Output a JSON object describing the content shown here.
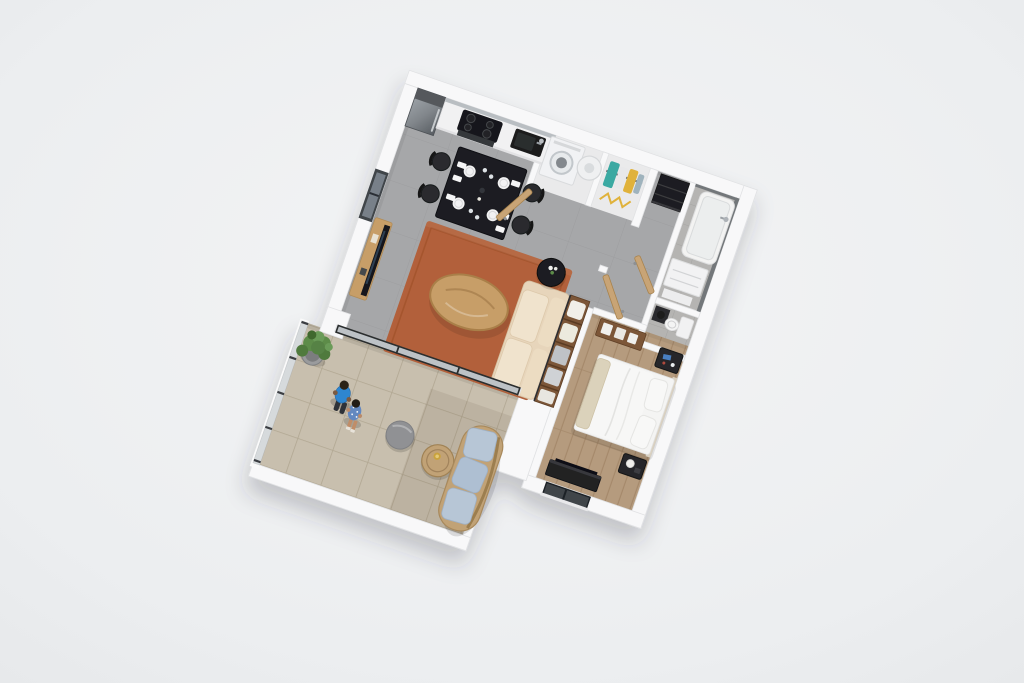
{
  "scene": {
    "type": "isometric-3d-floor-plan",
    "subject": "one-bedroom apartment with balcony, 3D render viewed from above",
    "rotation_deg": 19,
    "people_count": 2,
    "text_visible": "none"
  },
  "colors": {
    "background": "#eef0f1",
    "wall": "#f8f8f9",
    "floorMain": "#a6a7a9",
    "floorBedroom": "#b59b7e",
    "floorBalcony": "#c8bfae",
    "floorBath": "#b5b4b2",
    "floorCloset": "#eaeaeb",
    "rug": "#b2613a",
    "sofa": "#e7d5bb",
    "sofaCushion": "#f0e3cd",
    "walnut": "#7b5638",
    "woodLight": "#c79e68",
    "woodDoor": "#c8a476",
    "blackFurniture": "#1e1f21",
    "steel": "#82878c",
    "applianceWhite": "#f1f2f4",
    "bedWhite": "#f4f4f3",
    "throwBeige": "#dbd2bb",
    "frameDark": "#2c2d2f",
    "plantGreen": "#5d8c4a",
    "potGray": "#9a9b9d",
    "poufGray": "#909194",
    "rattan": "#c1a276",
    "cushionBlue": "#b7c6d6",
    "manShirt": "#2f86d0",
    "womanDress": "#6488c0",
    "teal": "#3aa9a2",
    "yellow": "#e0b23b",
    "bathWallDark": "#73777a",
    "tvDark": "#16181b"
  },
  "rooms": [
    {
      "id": "kitchen-dining",
      "furniture": [
        "refrigerator",
        "induction-cooktop",
        "oven",
        "black-sink",
        "dining-table-black",
        "dining-chairs-x4",
        "table-settings-x4"
      ]
    },
    {
      "id": "laundry-closet",
      "furniture": [
        "washing-machine",
        "water-heater",
        "open-wood-door"
      ]
    },
    {
      "id": "wardrobe-closet",
      "furniture": [
        "clothes-rail",
        "hanging-clothes-teal-yellow",
        "yellow-drying-rack"
      ]
    },
    {
      "id": "hallway",
      "furniture": [
        "dark-wardrobe"
      ]
    },
    {
      "id": "bathroom",
      "furniture": [
        "bathtub",
        "wall-faucet",
        "vanity-two-drawers",
        "bath-mat",
        "open-wood-door"
      ]
    },
    {
      "id": "wc",
      "furniture": [
        "toilet",
        "dark-cabinet"
      ]
    },
    {
      "id": "living-room",
      "furniture": [
        "terracotta-rug",
        "cream-sofa",
        "oval-oak-coffee-table",
        "black-round-side-table",
        "tv-sideboard",
        "leaning-tv",
        "walnut-shelving-divider",
        "sliding-glass-door"
      ]
    },
    {
      "id": "bedroom",
      "furniture": [
        "double-bed-white",
        "pillows-x2",
        "nightstand-north",
        "nightstand-south",
        "walnut-console",
        "tv-bench",
        "window-south",
        "open-wood-door"
      ]
    },
    {
      "id": "balcony",
      "furniture": [
        "potted-plant",
        "gray-pouf",
        "round-wood-table",
        "curved-rattan-sofa-blue-cushions",
        "glass-railing",
        "white-parapet"
      ],
      "people": [
        "man-blue-tshirt",
        "woman-floral-dress"
      ]
    }
  ]
}
